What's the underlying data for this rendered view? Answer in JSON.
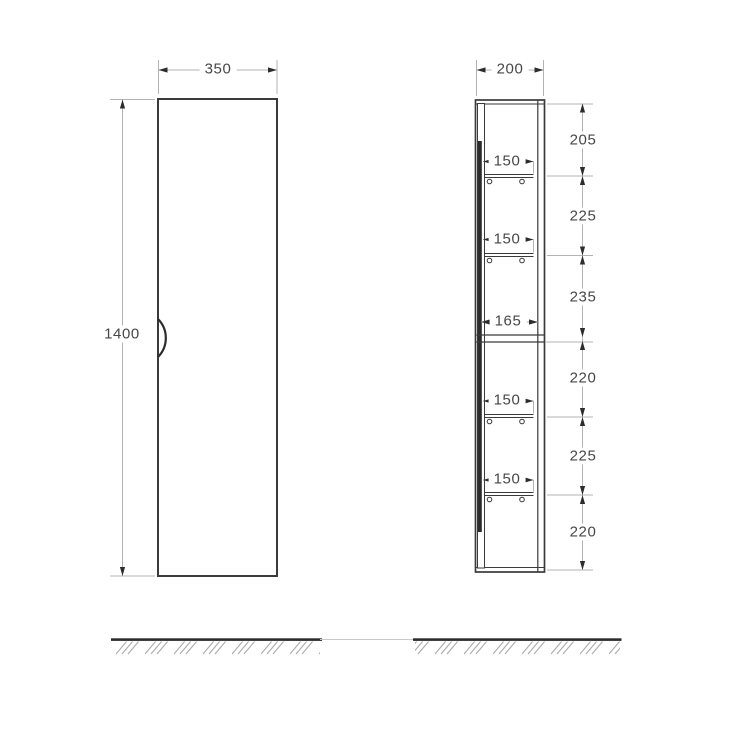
{
  "drawing": {
    "front_view": {
      "width_label": "350",
      "height_label": "1400"
    },
    "side_view": {
      "depth_label": "200",
      "internal_depth_labels": [
        "150",
        "150",
        "165",
        "150",
        "150"
      ],
      "height_segment_labels": [
        "205",
        "225",
        "235",
        "220",
        "225",
        "220"
      ]
    },
    "colors": {
      "outline": "#3a3a3a",
      "thick_line": "#2c2c2c",
      "dimension_line": "#b3b3b3",
      "text": "#474747",
      "background": "#ffffff"
    }
  }
}
